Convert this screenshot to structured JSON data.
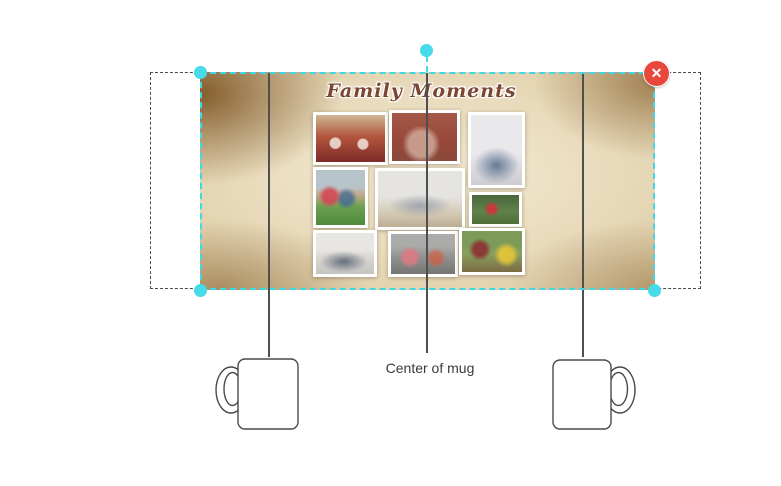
{
  "design": {
    "title": "Family Moments",
    "background": "vintage parchment texture",
    "photo_descriptions": [
      "wedding couple with red garlands under arch",
      "family holding children by red brick wall",
      "family seated together in light studio",
      "family lying on grass under sky",
      "large family group on sofa in studio",
      "couple playing on grass in green park",
      "family seated against light wall",
      "family portrait on gray backdrop",
      "family outdoors with green bokeh background"
    ]
  },
  "selection": {
    "close_icon": "✕"
  },
  "guides": {
    "center_label": "Center of mug"
  },
  "colors": {
    "accent_cyan": "#45dbe8",
    "danger_red": "#e8473c",
    "outline_gray": "#4f4f4f",
    "title_brown": "#7a4632",
    "parchment_base": "#dbc9a4"
  }
}
